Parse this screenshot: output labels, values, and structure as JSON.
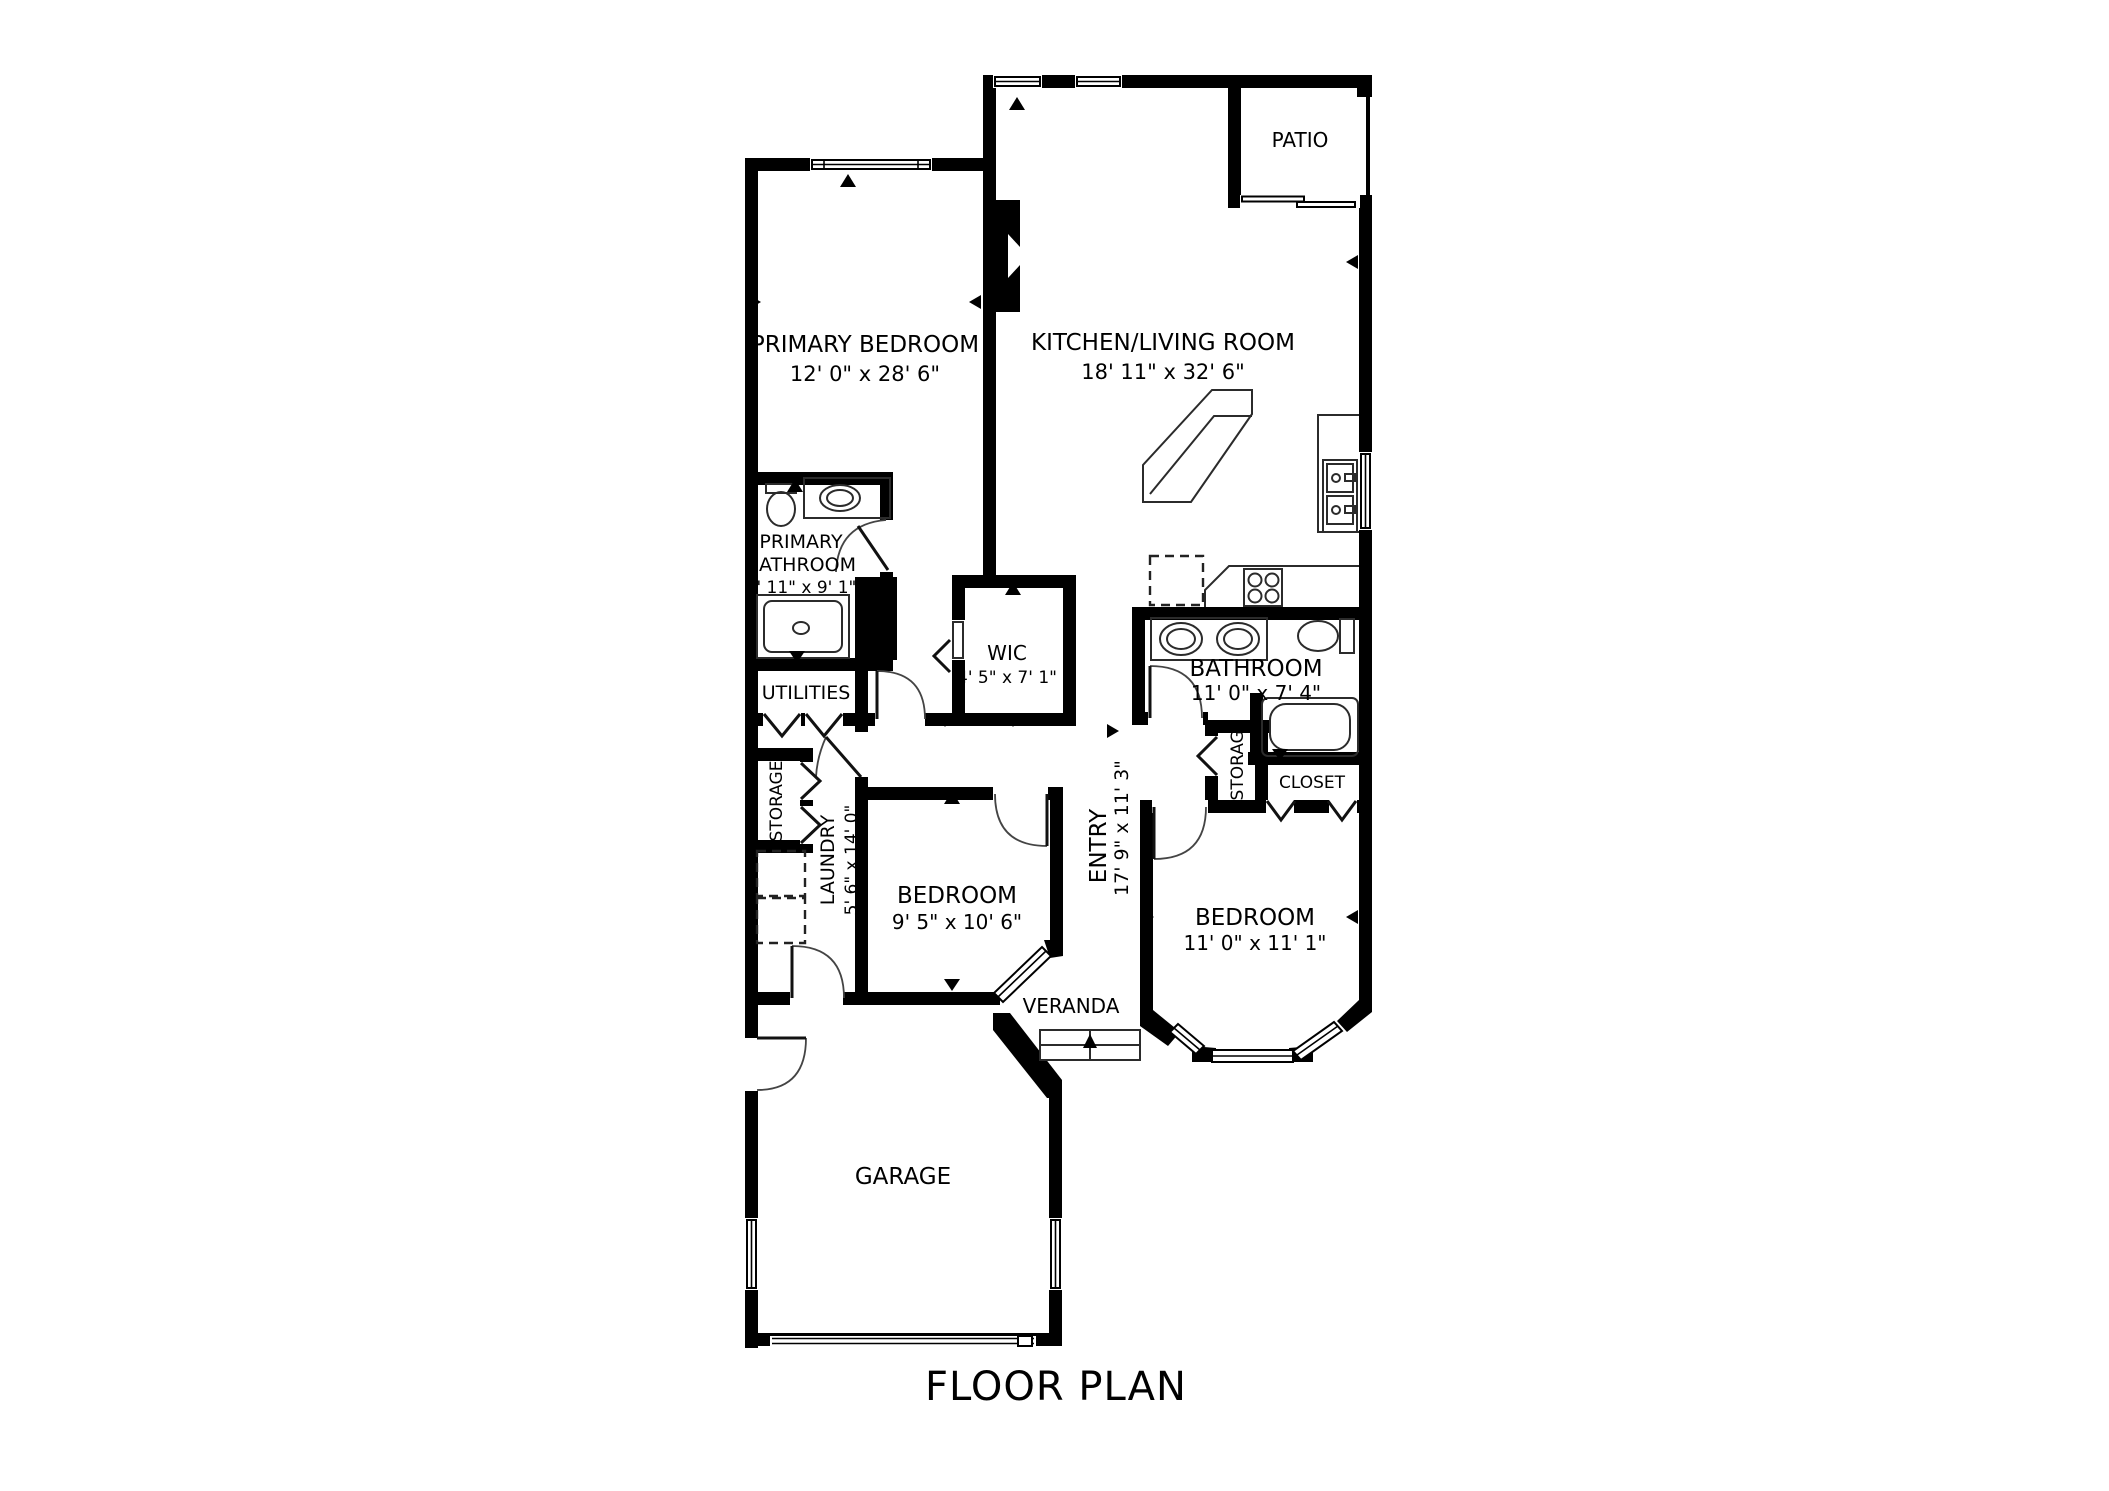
{
  "title": "FLOOR PLAN",
  "rooms": {
    "patio": {
      "name": "PATIO"
    },
    "primary_bedroom": {
      "name": "PRIMARY BEDROOM",
      "dims": "12' 0\" x 28' 6\""
    },
    "kitchen_living": {
      "name": "KITCHEN/LIVING ROOM",
      "dims": "18' 11\" x 32' 6\""
    },
    "primary_bathroom": {
      "line1": "PRIMARY",
      "line2": "BATHROOM",
      "dims": "6' 11\" x 9' 1\""
    },
    "wic": {
      "name": "WIC",
      "dims": "4' 5\" x 7' 1\""
    },
    "utilities": {
      "name": "UTILITIES"
    },
    "bathroom": {
      "name": "BATHROOM",
      "dims": "11' 0\" x 7' 4\""
    },
    "storage_left": {
      "name": "STORAGE"
    },
    "storage_right": {
      "name": "STORAGE"
    },
    "closet": {
      "name": "CLOSET"
    },
    "laundry": {
      "name": "LAUNDRY",
      "dims": "5' 6\" x 14' 0\""
    },
    "bedroom_middle": {
      "name": "BEDROOM",
      "dims": "9' 5\" x 10' 6\""
    },
    "entry": {
      "name": "ENTRY",
      "dims": "17' 9\" x 11' 3\""
    },
    "bedroom_right": {
      "name": "BEDROOM",
      "dims": "11' 0\" x 11' 1\""
    },
    "veranda": {
      "name": "VERANDA"
    },
    "garage": {
      "name": "GARAGE"
    }
  },
  "colors": {
    "wall": "#000000",
    "background": "#ffffff",
    "text": "#000000"
  }
}
